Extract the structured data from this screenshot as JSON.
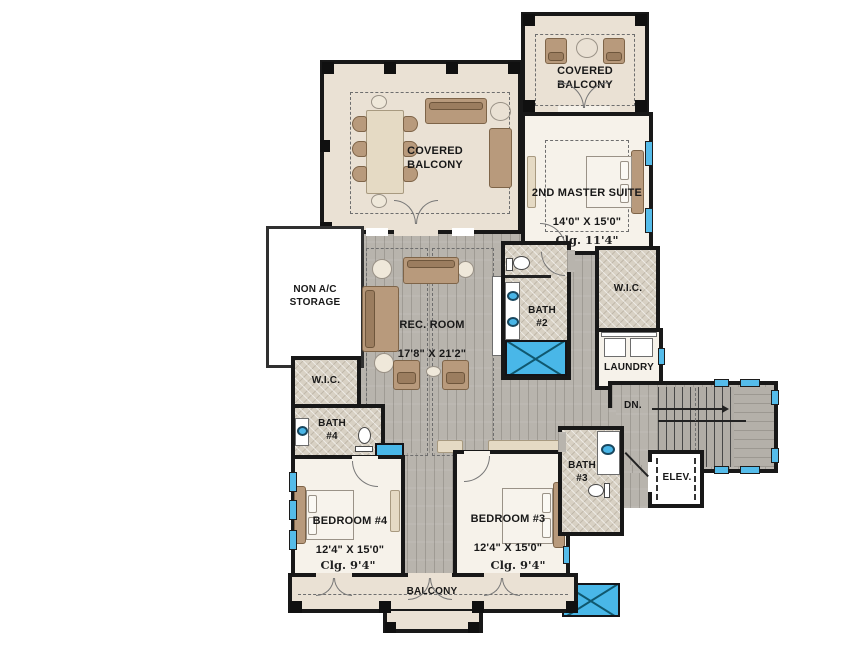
{
  "title": "Second floor plan",
  "rooms": {
    "covered_balcony_upper": {
      "label": "COVERED\nBALCONY"
    },
    "covered_balcony_left": {
      "label": "COVERED\nBALCONY"
    },
    "master_suite": {
      "name": "2ND MASTER SUITE",
      "dims": "14'0\" X 15'0\"",
      "ceiling": "Clg. 11'4\""
    },
    "non_ac_storage": {
      "label": "NON A/C\nSTORAGE"
    },
    "rec_room": {
      "name": "REC. ROOM",
      "dims": "17'8\" X 21'2\""
    },
    "bath_2": {
      "label": "BATH\n#2"
    },
    "wic_right": {
      "label": "W.I.C."
    },
    "laundry": {
      "label": "LAUNDRY"
    },
    "stairs": {
      "down_label": "DN."
    },
    "wic_left": {
      "label": "W.I.C."
    },
    "bath_4": {
      "label": "BATH\n#4"
    },
    "bedroom_4": {
      "name": "BEDROOM #4",
      "dims": "12'4\" X 15'0\"",
      "ceiling": "Clg. 9'4\""
    },
    "bedroom_3": {
      "name": "BEDROOM #3",
      "dims": "12'4\" X 15'0\"",
      "ceiling": "Clg. 9'4\""
    },
    "bath_3": {
      "label": "BATH\n#3"
    },
    "elevator": {
      "label": "ELEV."
    },
    "balcony_bottom": {
      "label": "BALCONY"
    }
  },
  "colors": {
    "wall": "#181818",
    "balcony_floor": "#eae1d4",
    "room_floor": "#f6f2ea",
    "tile_floor": "#d8d1c4",
    "wood_floor": "#b8b4ad",
    "water_fixture_blue": "#49b7e8",
    "furniture_tan": "#b89a7c",
    "background": "#ffffff"
  }
}
